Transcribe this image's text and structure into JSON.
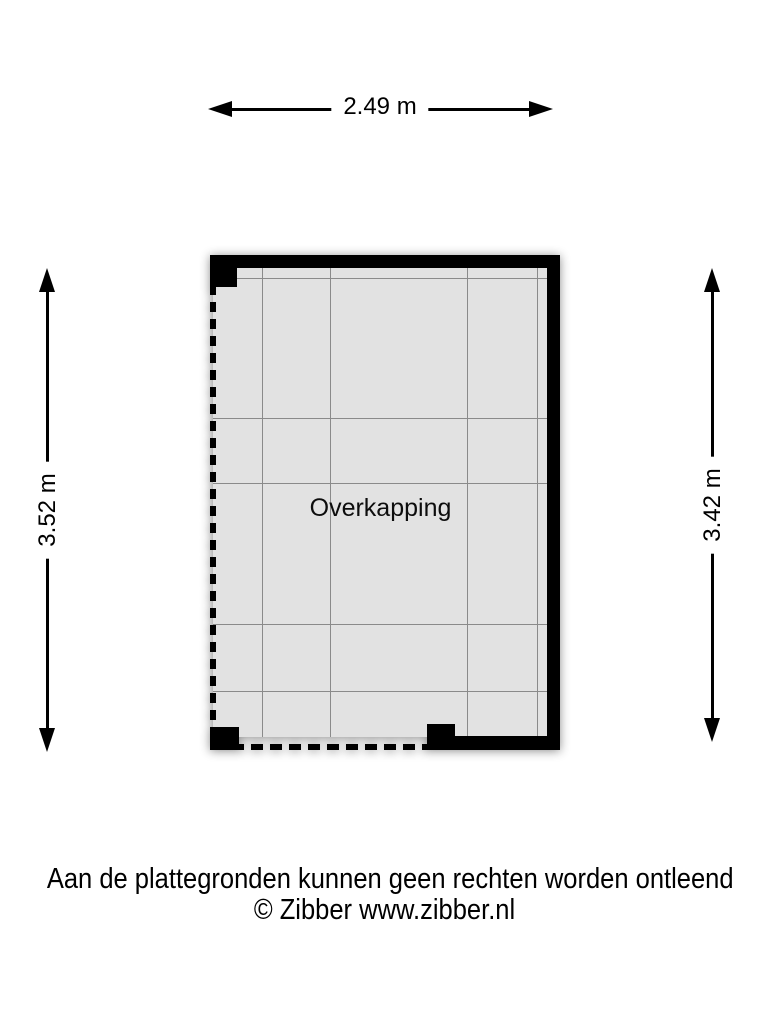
{
  "floor_plan": {
    "room_label": "Overkapping",
    "dimension_top": "2.49 m",
    "dimension_left": "3.52 m",
    "dimension_right": "3.42 m",
    "colors": {
      "wall": "#000000",
      "floor_fill": "#e2e2e2",
      "grid_line": "#8a8a8a",
      "background": "#ffffff"
    }
  },
  "footer": {
    "disclaimer": "Aan de plattegronden kunnen geen rechten worden ontleend",
    "copyright": "© Zibber www.zibber.nl"
  }
}
